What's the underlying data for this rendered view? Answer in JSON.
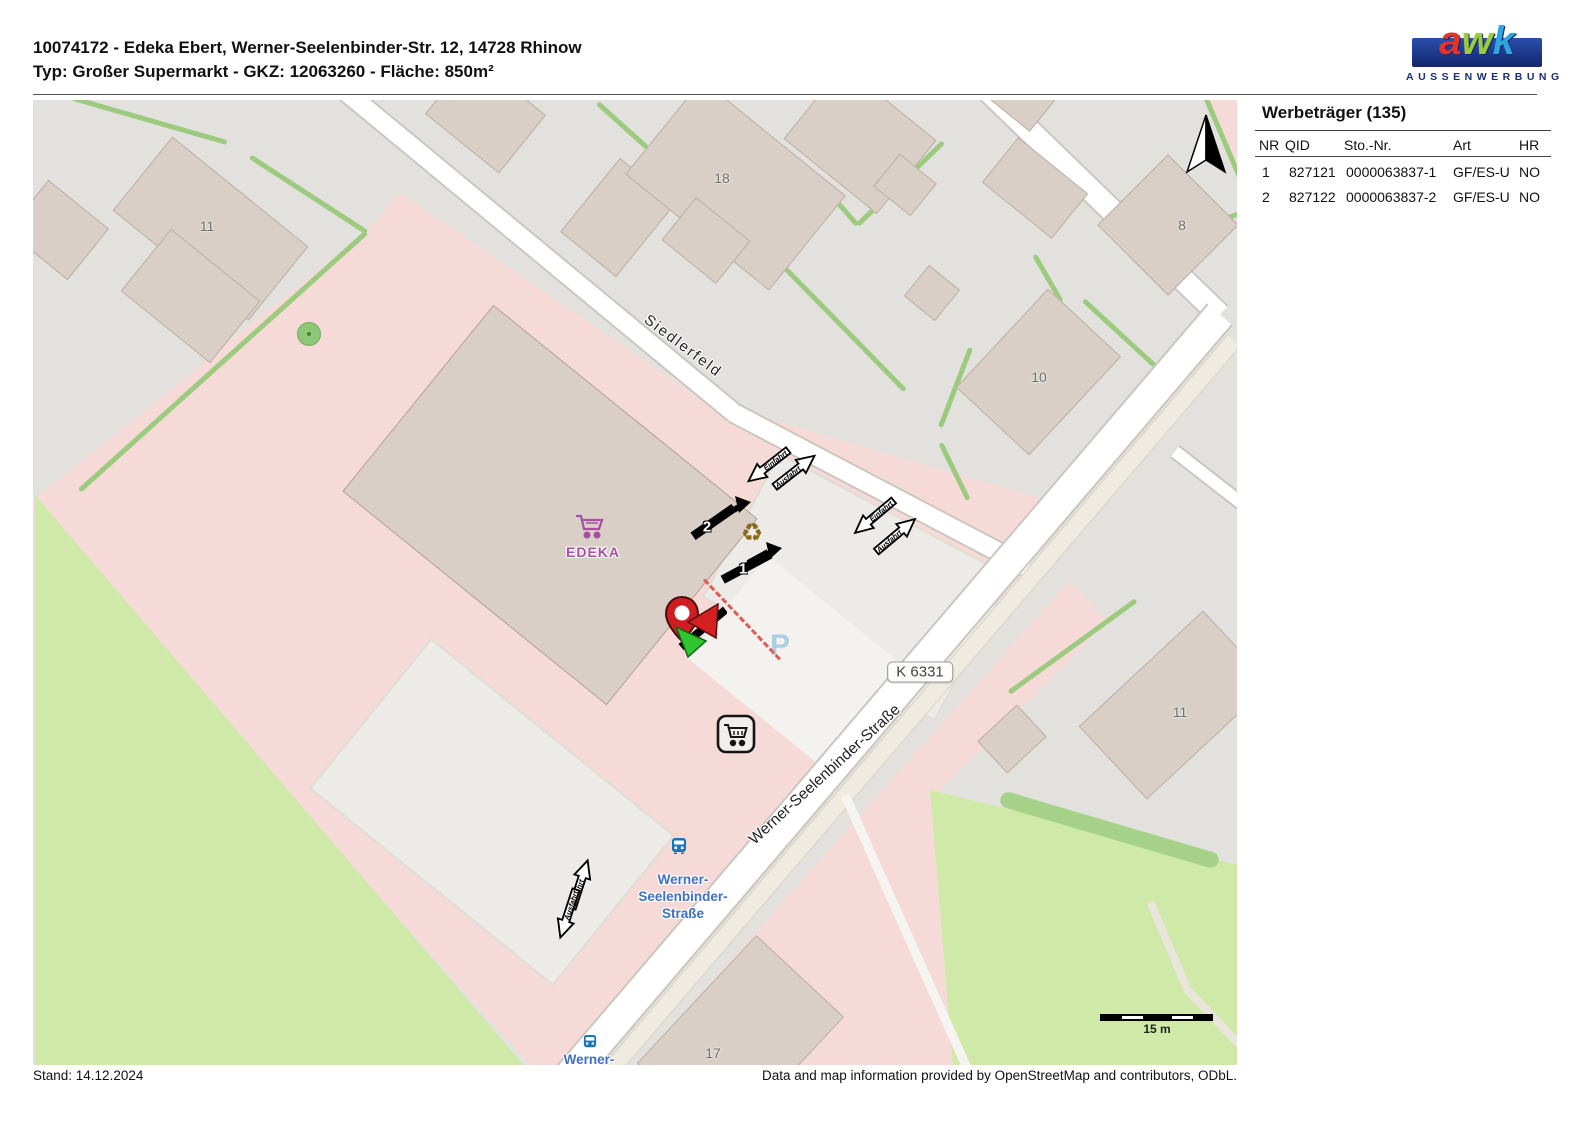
{
  "header": {
    "line1": "10074172 - Edeka Ebert, Werner-Seelenbinder-Str. 12, 14728 Rhinow",
    "line2": "Typ: Großer Supermarkt - GKZ: 12063260 - Fläche: 850m²"
  },
  "logo": {
    "letters": [
      "a",
      "w",
      "k"
    ],
    "subtitle": "AUSSENWERBUNG",
    "bar_color": "#1c3a85",
    "letter_colors": [
      "#e63329",
      "#9bca3c",
      "#2ea7e0"
    ]
  },
  "panel": {
    "title": "Werbeträger (135)",
    "columns": {
      "nr": "NR",
      "qid": "QID",
      "sto": "Sto.-Nr.",
      "art": "Art",
      "hr": "HR"
    },
    "rows": [
      {
        "nr": "1",
        "qid": "827121",
        "sto": "0000063837-1",
        "art": "GF/ES-U",
        "hr": "NO"
      },
      {
        "nr": "2",
        "qid": "827122",
        "sto": "0000063837-2",
        "art": "GF/ES-U",
        "hr": "NO"
      }
    ]
  },
  "map": {
    "street_siedlerfeld": "Siedlerfeld",
    "street_ws": "Werner-Seelenbinder-Straße",
    "road_ref": "K 6331",
    "edeka_label": "EDEKA",
    "parking_symbol": "P",
    "bus_stop_lines": [
      "Werner-",
      "Seelenbinder-",
      "Straße"
    ],
    "bus_stop2": "Werner-",
    "house_numbers": [
      "11",
      "18",
      "10",
      "8",
      "11",
      "17"
    ],
    "markers": {
      "m1": "1",
      "m2": "2"
    },
    "entrance": "Einfahrt",
    "exit": "Ausfahrt",
    "scale": "15 m",
    "recycle_icon": "♻",
    "colors": {
      "pink_area": "#f6dad7",
      "grass": "#cfe9a9",
      "building": "#d9cfc7",
      "edeka_purple": "#a84fa3",
      "bus_blue": "#1877bb",
      "parking_blue": "#abcfe3"
    }
  },
  "footer": {
    "stand": "Stand: 14.12.2024",
    "attribution": "Data and map information provided by OpenStreetMap and contributors, ODbL."
  }
}
